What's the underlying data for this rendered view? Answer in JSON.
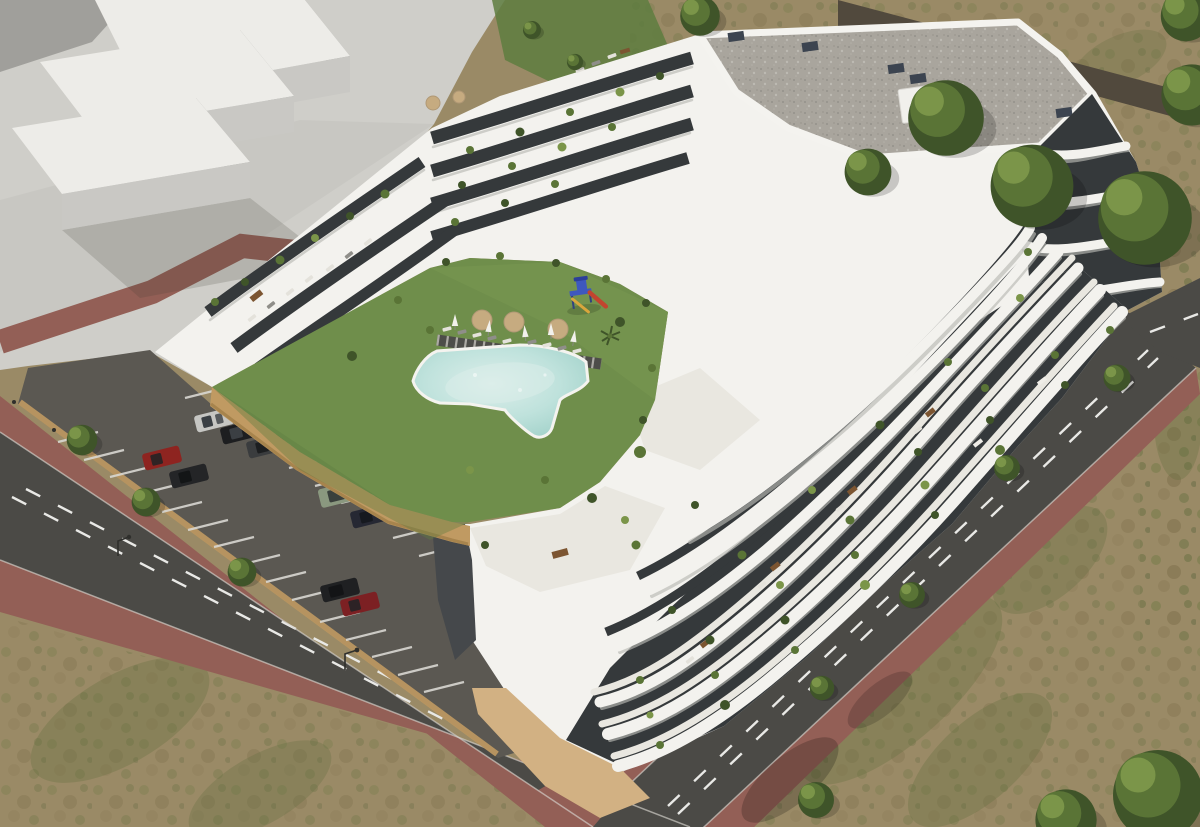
{
  "meta": {
    "title": "Aerial 3D render of a terraced white apartment complex",
    "description": "Bird's-eye architectural rendering: a curved, terraced white residential building with charcoal glass facades and wavy balcony bands wraps a courtyard containing a bright lawn, an irregular turquoise swimming pool with timber boardwalk, sun loungers, parasols, round daybeds and a children's playground. A sunken parking lot with painted stalls and nine cars sits behind a tan retaining wall; asphalt roads with dashed markings and reddish paver sidewalks border the site, with a plain white massing-model block at top-left and scrubland with trees around the edges."
  },
  "palette": {
    "plaza": "#cfcec9",
    "massing-top": "#edece8",
    "massing-front": "#c9c8c4",
    "massing-side": "#a09f9b",
    "dirt": "#9a8a66",
    "path-dark": "#51493d",
    "sidewalk": "#935f56",
    "road": "#4b4a46",
    "road-line": "#e9e9e6",
    "curb": "#d7d4ce",
    "parking": "#5b5852",
    "stall-line": "#d8d7d2",
    "wall-tan": "#c09a62",
    "wall-tan-dark": "#a07e48",
    "lawn": "#6f8e4b",
    "lawn-light": "#7f9e57",
    "lawn-dark": "#5e7c40",
    "pool-rim": "#f4f3ef",
    "pool-1": "#dceeea",
    "pool-2": "#bfe2dc",
    "pool-3": "#9fd0c8",
    "walk-dark": "#4d4d49",
    "plank": "#c4c2bb",
    "bldg": "#f3f2ee",
    "band-shadow": "#b9b8b3",
    "terrace": "#e9e7e0",
    "facade": "#35393b",
    "roof-gravel": "#a9a59d",
    "base-tan": "#d2b183",
    "patio": "#45484b",
    "tree-dark": "#3f5429",
    "tree-mid": "#5a7436",
    "tree-light": "#7b9549",
    "pg-blue": "#3e58bf",
    "pg-red": "#c2452f",
    "pg-yellow": "#d9a63c",
    "table-tan": "#c6ab80",
    "furn-brown": "#7c5531",
    "lounger-light": "#e4e2db",
    "lounger-dark": "#8f8e89",
    "umbrella": "#f2f1ec"
  },
  "scene": {
    "cars": [
      {
        "name": "silver-hatchback",
        "color": "#c6c6c3"
      },
      {
        "name": "black-sedan",
        "color": "#1d1e20"
      },
      {
        "name": "graphite-sedan",
        "color": "#3a3c3e"
      },
      {
        "name": "red-hatchback",
        "color": "#8e2420"
      },
      {
        "name": "black-hatchback",
        "color": "#242527"
      },
      {
        "name": "sage-green-suv",
        "color": "#8a987f"
      },
      {
        "name": "dark-navy-sedan",
        "color": "#262833"
      },
      {
        "name": "black-estate",
        "color": "#1f2022"
      },
      {
        "name": "dark-red-hatchback",
        "color": "#7c2023"
      }
    ],
    "amenities": [
      "swimming-pool",
      "lawn-courtyard",
      "children-playground",
      "timber-boardwalk",
      "sun-loungers",
      "parasols",
      "round-daybeds",
      "rooftop-terraces",
      "gravel-roof",
      "parking-lot"
    ],
    "counts": {
      "cars": 9,
      "parking-stall-rows": 3,
      "courtyard-parasols": 5,
      "round-daybeds": 3,
      "poolside-loungers": 9,
      "street-trees": 4,
      "parking-trees": 3
    }
  }
}
